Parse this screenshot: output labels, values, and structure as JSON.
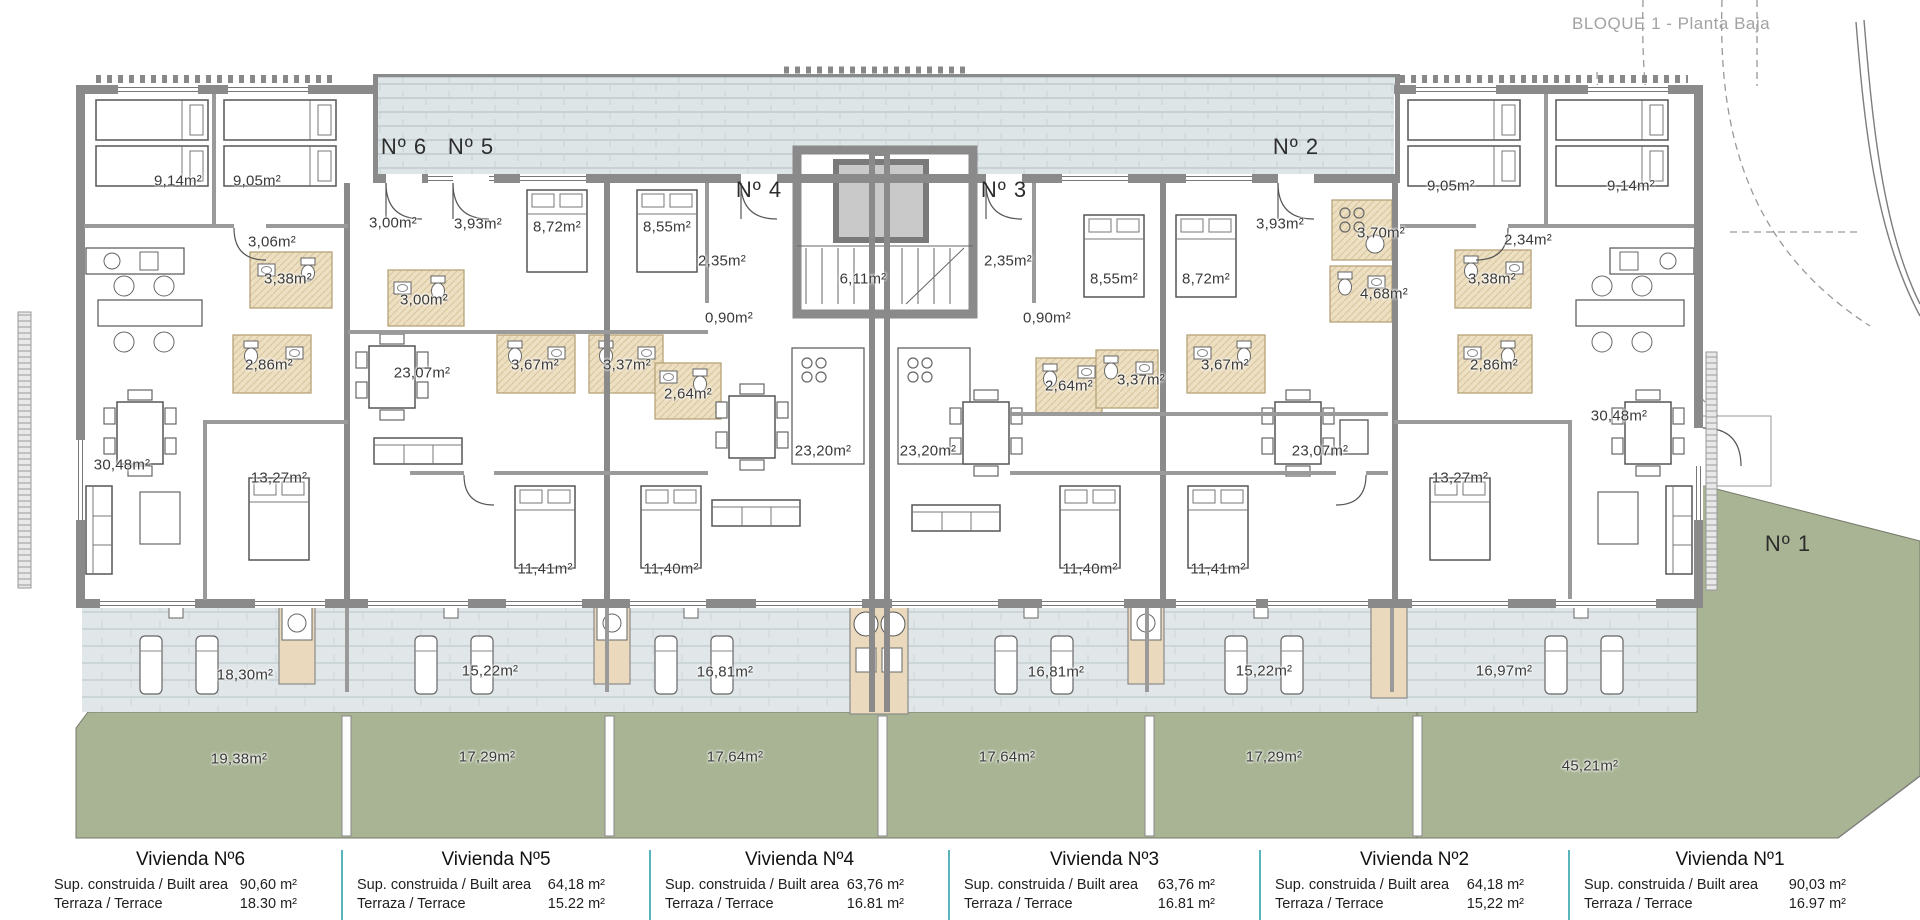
{
  "header": {
    "title": "BLOQUE 1 - Planta Baja"
  },
  "colors": {
    "wall_gray": "#8a8a8a",
    "garden_green": "#a8b494",
    "terrace_tile": "#e1e7e9",
    "patio_tile": "#dde5e7",
    "bathroom_beige": "#ecdfc2",
    "table_separator_teal": "#58b5bc",
    "title_gray": "#a3a3a3"
  },
  "plan": {
    "unit_markers": [
      {
        "text": "Nº 6",
        "x": 404,
        "y": 147
      },
      {
        "text": "Nº 5",
        "x": 471,
        "y": 147
      },
      {
        "text": "Nº 4",
        "x": 759,
        "y": 190
      },
      {
        "text": "Nº 3",
        "x": 1004,
        "y": 190
      },
      {
        "text": "Nº 2",
        "x": 1296,
        "y": 147
      },
      {
        "text": "Nº 1",
        "x": 1788,
        "y": 544
      }
    ],
    "area_labels": [
      {
        "text": "9,14m²",
        "x": 178,
        "y": 181
      },
      {
        "text": "9,05m²",
        "x": 257,
        "y": 181
      },
      {
        "text": "3,06m²",
        "x": 272,
        "y": 242
      },
      {
        "text": "3,00m²",
        "x": 393,
        "y": 223
      },
      {
        "text": "3,38m²",
        "x": 288,
        "y": 279
      },
      {
        "text": "3,00m²",
        "x": 424,
        "y": 300
      },
      {
        "text": "2,86m²",
        "x": 269,
        "y": 365
      },
      {
        "text": "30,48m²",
        "x": 122,
        "y": 465
      },
      {
        "text": "13,27m²",
        "x": 279,
        "y": 478
      },
      {
        "text": "23,07m²",
        "x": 422,
        "y": 373
      },
      {
        "text": "3,93m²",
        "x": 478,
        "y": 224
      },
      {
        "text": "8,72m²",
        "x": 557,
        "y": 227
      },
      {
        "text": "8,55m²",
        "x": 667,
        "y": 227
      },
      {
        "text": "3,67m²",
        "x": 535,
        "y": 365
      },
      {
        "text": "3,37m²",
        "x": 627,
        "y": 365
      },
      {
        "text": "2,64m²",
        "x": 688,
        "y": 394
      },
      {
        "text": "11,41m²",
        "x": 545,
        "y": 569
      },
      {
        "text": "11,40m²",
        "x": 671,
        "y": 569
      },
      {
        "text": "2,35m²",
        "x": 722,
        "y": 261
      },
      {
        "text": "0,90m²",
        "x": 729,
        "y": 318
      },
      {
        "text": "6,11m²",
        "x": 863,
        "y": 279
      },
      {
        "text": "23,20m²",
        "x": 823,
        "y": 451
      },
      {
        "text": "2,35m²",
        "x": 1008,
        "y": 261
      },
      {
        "text": "0,90m²",
        "x": 1047,
        "y": 318
      },
      {
        "text": "8,55m²",
        "x": 1114,
        "y": 279
      },
      {
        "text": "8,72m²",
        "x": 1206,
        "y": 279
      },
      {
        "text": "2,64m²",
        "x": 1069,
        "y": 386
      },
      {
        "text": "3,37m²",
        "x": 1141,
        "y": 380
      },
      {
        "text": "3,67m²",
        "x": 1225,
        "y": 365
      },
      {
        "text": "23,20m²",
        "x": 928,
        "y": 451
      },
      {
        "text": "11,40m²",
        "x": 1090,
        "y": 569
      },
      {
        "text": "11,41m²",
        "x": 1218,
        "y": 569
      },
      {
        "text": "3,93m²",
        "x": 1280,
        "y": 224
      },
      {
        "text": "3,70m²",
        "x": 1381,
        "y": 233
      },
      {
        "text": "4,68m²",
        "x": 1384,
        "y": 294
      },
      {
        "text": "23,07m²",
        "x": 1320,
        "y": 451
      },
      {
        "text": "13,27m²",
        "x": 1460,
        "y": 478
      },
      {
        "text": "9,05m²",
        "x": 1451,
        "y": 186
      },
      {
        "text": "9,14m²",
        "x": 1631,
        "y": 186
      },
      {
        "text": "2,34m²",
        "x": 1528,
        "y": 240
      },
      {
        "text": "3,38m²",
        "x": 1492,
        "y": 279
      },
      {
        "text": "2,86m²",
        "x": 1494,
        "y": 365
      },
      {
        "text": "30,48m²",
        "x": 1619,
        "y": 416
      },
      {
        "text": "18,30m²",
        "x": 245,
        "y": 675
      },
      {
        "text": "15,22m²",
        "x": 490,
        "y": 671
      },
      {
        "text": "16,81m²",
        "x": 725,
        "y": 672
      },
      {
        "text": "16,81m²",
        "x": 1056,
        "y": 672
      },
      {
        "text": "15,22m²",
        "x": 1264,
        "y": 671
      },
      {
        "text": "16,97m²",
        "x": 1504,
        "y": 671
      },
      {
        "text": "19,38m²",
        "x": 239,
        "y": 759
      },
      {
        "text": "17,29m²",
        "x": 487,
        "y": 757
      },
      {
        "text": "17,64m²",
        "x": 735,
        "y": 757
      },
      {
        "text": "17,64m²",
        "x": 1007,
        "y": 757
      },
      {
        "text": "17,29m²",
        "x": 1274,
        "y": 757
      },
      {
        "text": "45,21m²",
        "x": 1590,
        "y": 766
      }
    ]
  },
  "table": {
    "columns": [
      {
        "title": "Vivienda Nº6",
        "rows": [
          {
            "label": "Sup. construida / Built area",
            "value": "90,60 m²"
          },
          {
            "label": "Terraza / Terrace",
            "value": "18.30 m²"
          }
        ]
      },
      {
        "title": "Vivienda Nº5",
        "rows": [
          {
            "label": "Sup. construida / Built area",
            "value": "64,18 m²"
          },
          {
            "label": "Terraza / Terrace",
            "value": "15.22 m²"
          }
        ]
      },
      {
        "title": "Vivienda Nº4",
        "rows": [
          {
            "label": "Sup. construida / Built area",
            "value": "63,76 m²"
          },
          {
            "label": "Terraza / Terrace",
            "value": "16.81 m²"
          }
        ]
      },
      {
        "title": "Vivienda Nº3",
        "rows": [
          {
            "label": "Sup. construida / Built area",
            "value": "63,76 m²"
          },
          {
            "label": "Terraza / Terrace",
            "value": "16.81 m²"
          }
        ]
      },
      {
        "title": "Vivienda Nº2",
        "rows": [
          {
            "label": "Sup. construida / Built area",
            "value": "64,18 m²"
          },
          {
            "label": "Terraza / Terrace",
            "value": "15,22 m²"
          }
        ]
      },
      {
        "title": "Vivienda Nº1",
        "rows": [
          {
            "label": "Sup. construida / Built area",
            "value": "90,03 m²"
          },
          {
            "label": "Terraza / Terrace",
            "value": "16.97 m²"
          }
        ]
      }
    ]
  }
}
